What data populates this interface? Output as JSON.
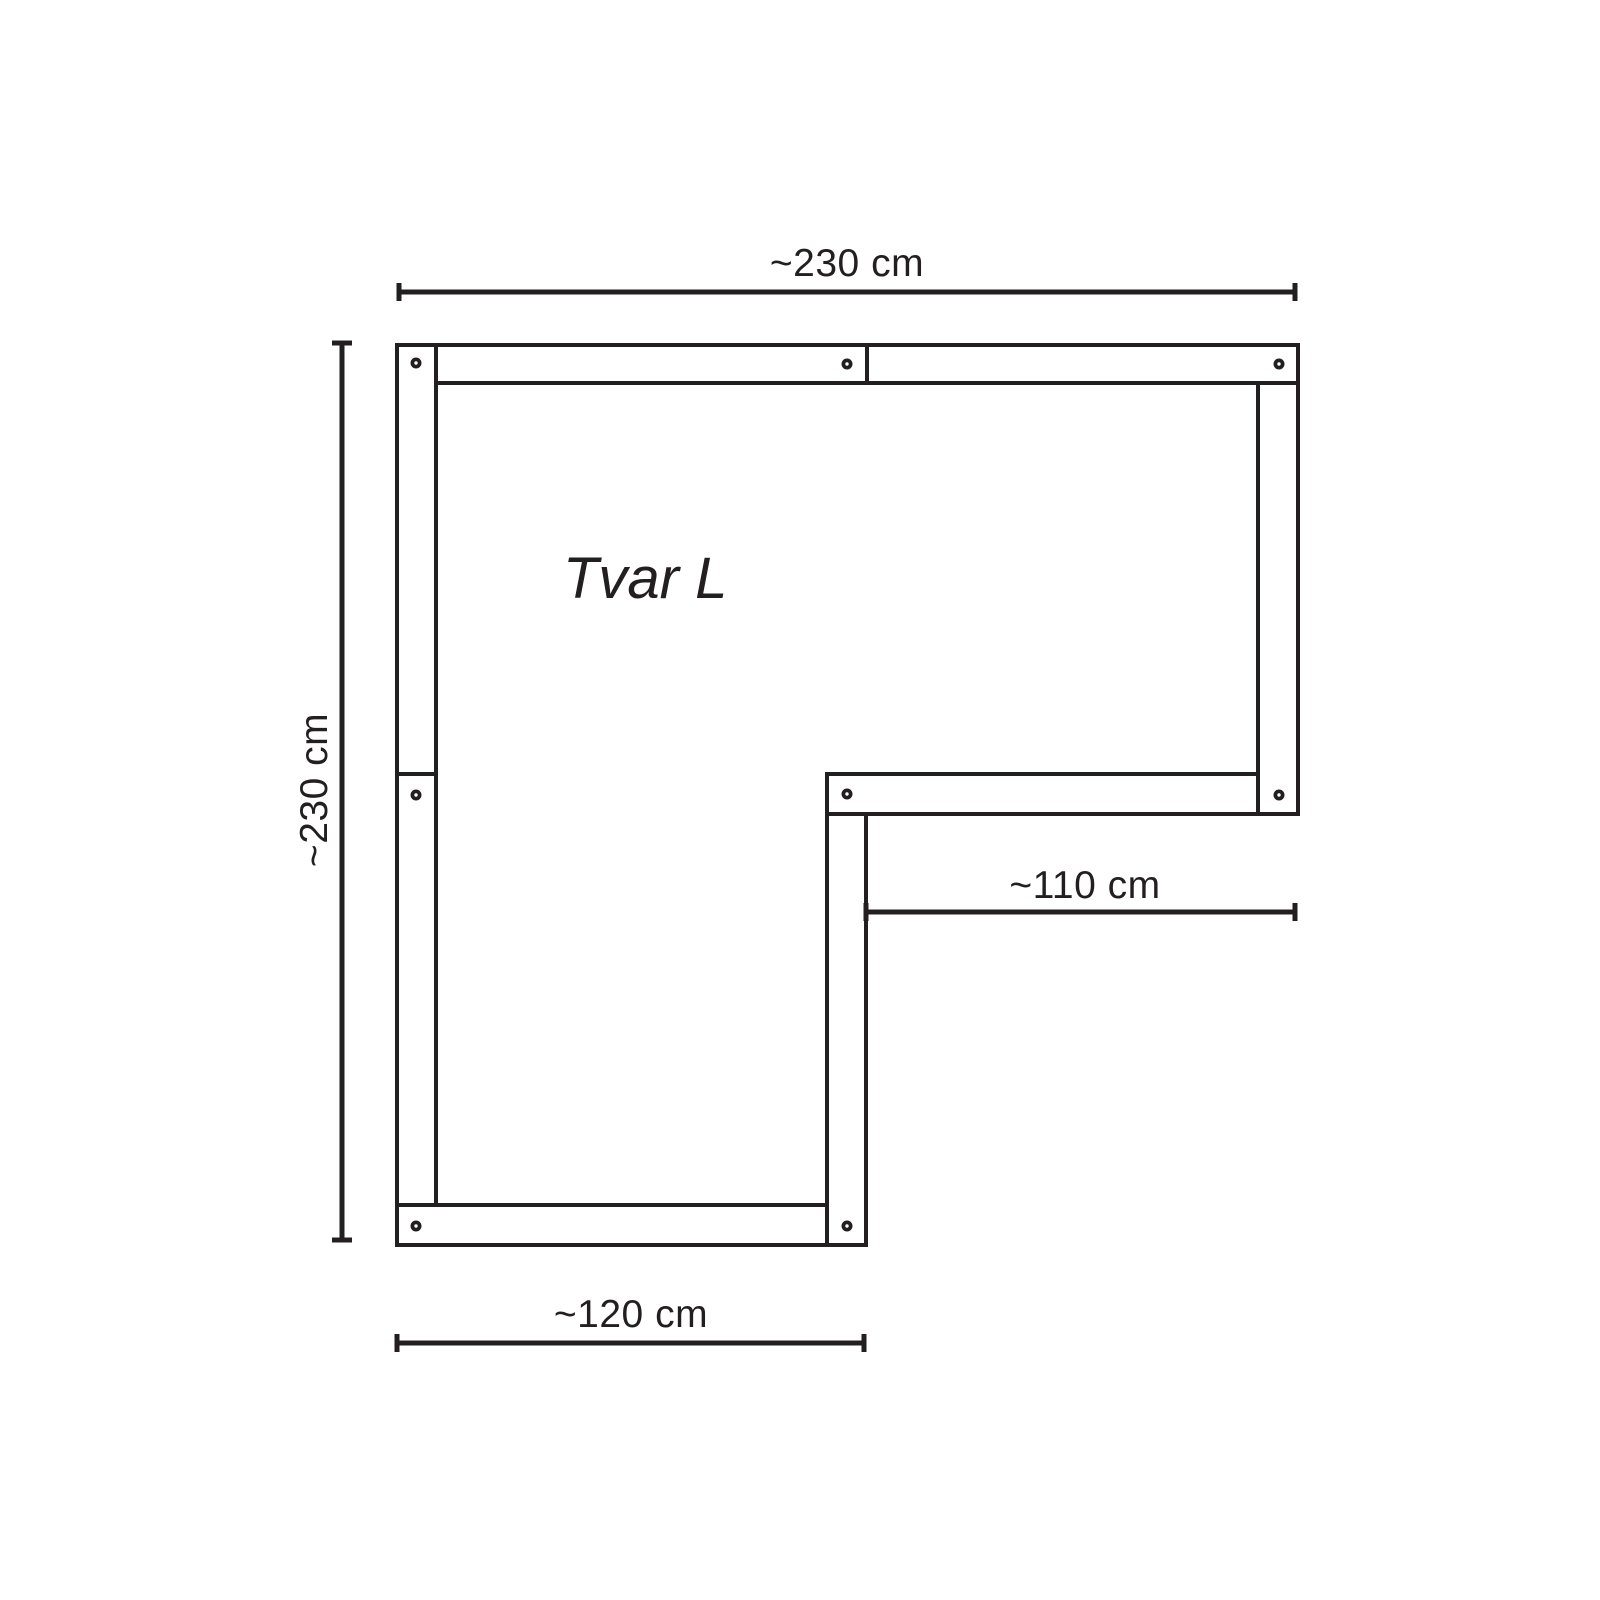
{
  "diagram": {
    "title": "Tvar L",
    "shape": "L-shaped frame plan view",
    "colors": {
      "line": "#231f20",
      "beam_fill": "#ffffff",
      "background": "#ffffff"
    },
    "dimension_lines": [
      {
        "id": "top",
        "label": "~230 cm",
        "axis": "h",
        "line": {
          "x1": 399,
          "y1": 292,
          "x2": 1295,
          "y2": 292
        }
      },
      {
        "id": "left",
        "label": "~230 cm",
        "axis": "v",
        "line": {
          "x1": 342,
          "y1": 343,
          "x2": 342,
          "y2": 1240
        }
      },
      {
        "id": "inner-right",
        "label": "~110 cm",
        "axis": "h",
        "line": {
          "x1": 866,
          "y1": 912,
          "x2": 1295,
          "y2": 912
        }
      },
      {
        "id": "bottom",
        "label": "~120 cm",
        "axis": "h",
        "line": {
          "x1": 397,
          "y1": 1343,
          "x2": 864,
          "y2": 1343
        }
      }
    ],
    "beams": [
      {
        "id": "left-lower",
        "x": 397,
        "y": 774,
        "w": 39,
        "h": 431
      },
      {
        "id": "bottom",
        "x": 397,
        "y": 1205,
        "w": 430,
        "h": 40
      },
      {
        "id": "arm-right",
        "x": 827,
        "y": 814,
        "w": 39,
        "h": 431
      },
      {
        "id": "middle",
        "x": 827,
        "y": 774,
        "w": 431,
        "h": 40
      },
      {
        "id": "right",
        "x": 1258,
        "y": 383,
        "w": 40,
        "h": 431
      },
      {
        "id": "top-right",
        "x": 867,
        "y": 345,
        "w": 431,
        "h": 38
      },
      {
        "id": "top-left",
        "x": 436,
        "y": 345,
        "w": 431,
        "h": 38
      },
      {
        "id": "left-upper",
        "x": 397,
        "y": 345,
        "w": 39,
        "h": 429
      }
    ],
    "screws": [
      {
        "x": 416,
        "y": 363
      },
      {
        "x": 847,
        "y": 364
      },
      {
        "x": 1279,
        "y": 364
      },
      {
        "x": 416,
        "y": 795
      },
      {
        "x": 847,
        "y": 794
      },
      {
        "x": 1279,
        "y": 795
      },
      {
        "x": 416,
        "y": 1226
      },
      {
        "x": 847,
        "y": 1226
      }
    ]
  }
}
